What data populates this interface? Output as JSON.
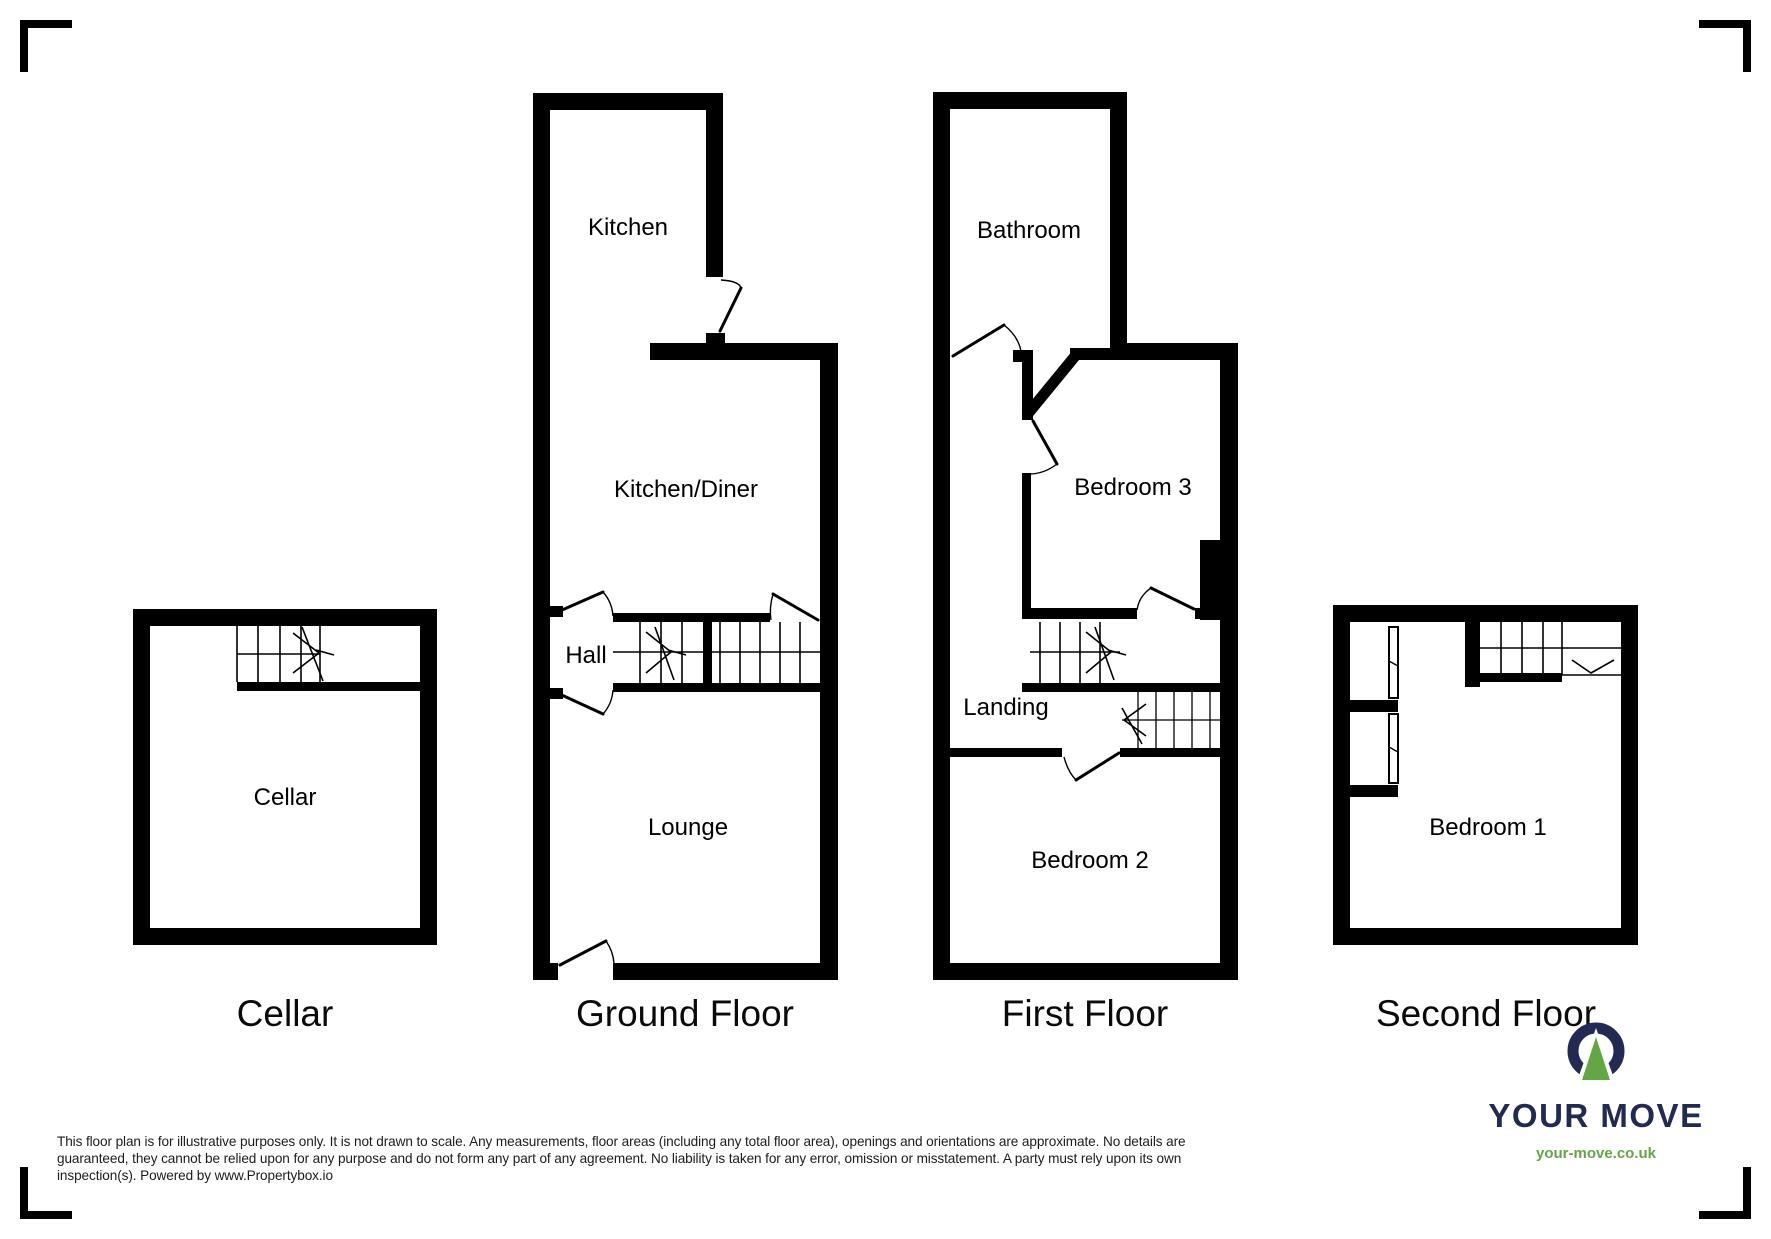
{
  "document": {
    "kind": "estate-agent-floor-plan",
    "background": "#ffffff",
    "wall_color": "#000000"
  },
  "plans": [
    {
      "id": "cellar",
      "title": "Cellar",
      "rooms": [
        {
          "label": "Cellar"
        }
      ]
    },
    {
      "id": "ground-floor",
      "title": "Ground Floor",
      "rooms": [
        {
          "label": "Kitchen"
        },
        {
          "label": "Kitchen/Diner"
        },
        {
          "label": "Hall"
        },
        {
          "label": "Lounge"
        }
      ]
    },
    {
      "id": "first-floor",
      "title": "First Floor",
      "rooms": [
        {
          "label": "Bathroom"
        },
        {
          "label": "Bedroom 3"
        },
        {
          "label": "Landing"
        },
        {
          "label": "Bedroom 2"
        }
      ]
    },
    {
      "id": "second-floor",
      "title": "Second Floor",
      "rooms": [
        {
          "label": "Bedroom 1"
        }
      ]
    }
  ],
  "footer": {
    "disclaimer_lines": [
      "This floor plan is for illustrative purposes only. It is not drawn to scale. Any measurements, floor areas (including any total floor area), openings and orientations are approximate. No details are",
      "guaranteed, they cannot be relied upon for any purpose and do not form any part of any agreement. No liability is taken for any error, omission or misstatement. A party must rely upon its own",
      "inspection(s). Powered by www.Propertybox.io"
    ]
  },
  "logo": {
    "brand": "YOUR MOVE",
    "website": "your-move.co.uk",
    "colors": {
      "navy": "#212a52",
      "green": "#62a744"
    }
  }
}
